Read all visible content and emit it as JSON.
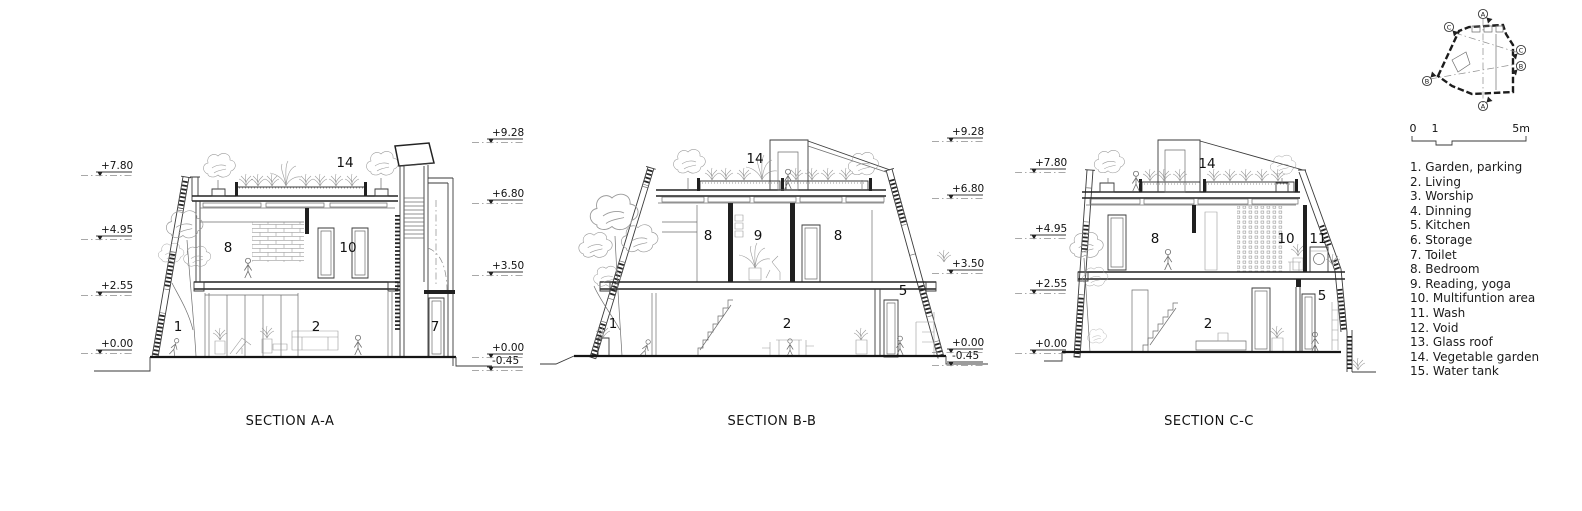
{
  "drawing": {
    "line_color": "#1f1f1f",
    "background": "#ffffff",
    "sections": [
      {
        "title": "SECTION A-A",
        "levels_left": [
          "+7.80",
          "+4.95",
          "+2.55",
          "+0.00"
        ],
        "levels_right": [
          "+9.28",
          "+6.80",
          "+3.50",
          "+0.00",
          "-0.45"
        ],
        "rooms": [
          "14",
          "8",
          "10",
          "1",
          "2",
          "7"
        ]
      },
      {
        "title": "SECTION B-B",
        "levels_left": [],
        "levels_right": [
          "+9.28",
          "+6.80",
          "+3.50",
          "+0.00",
          "-0.45"
        ],
        "rooms": [
          "14",
          "8",
          "9",
          "8",
          "1",
          "2",
          "5"
        ]
      },
      {
        "title": "SECTION C-C",
        "levels_left": [
          "+7.80",
          "+4.95",
          "+2.55",
          "+0.00"
        ],
        "levels_right": [],
        "rooms": [
          "14",
          "8",
          "10",
          "11",
          "2",
          "5"
        ]
      }
    ],
    "scale_bar": {
      "zero": "0",
      "one": "1",
      "five": "5m"
    },
    "key_plan": {
      "markers": [
        "A",
        "A",
        "B",
        "B",
        "C",
        "C"
      ]
    },
    "legend": {
      "items": [
        "1. Garden, parking",
        "2. Living",
        "3. Worship",
        "4. Dinning",
        "5. Kitchen",
        "6. Storage",
        "7. Toilet",
        "8. Bedroom",
        "9. Reading, yoga",
        "10. Multifuntion area",
        "11. Wash",
        "12. Void",
        "13. Glass roof",
        "14. Vegetable garden",
        "15. Water tank"
      ]
    }
  }
}
